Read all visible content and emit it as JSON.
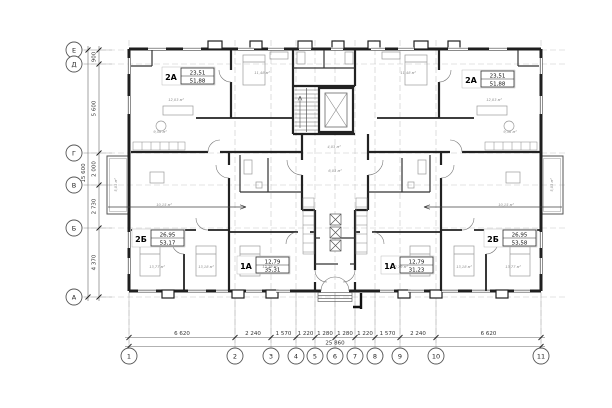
{
  "drawing": {
    "kind": "apartment floor plan"
  },
  "axes": {
    "left": [
      "Е",
      "Д",
      "Г",
      "В",
      "Б",
      "А"
    ],
    "bottom": [
      "1",
      "2",
      "3",
      "4",
      "5",
      "6",
      "7",
      "8",
      "9",
      "10",
      "11"
    ]
  },
  "dims": {
    "left": [
      "900",
      "5 600",
      "2 000",
      "2 730",
      "4 370"
    ],
    "left_total": "15 600",
    "bottom": [
      "6 620",
      "2 240",
      "1 570",
      "1 220",
      "1 280",
      "1 280",
      "1 220",
      "1 570",
      "2 240",
      "6 620"
    ],
    "bottom_total": "25 860"
  },
  "apartments": [
    {
      "type": "2А",
      "living": "23,51",
      "total": "51,88"
    },
    {
      "type": "2А",
      "living": "23,51",
      "total": "51,88"
    },
    {
      "type": "2Б",
      "living": "26,95",
      "total": "53,17"
    },
    {
      "type": "2Б",
      "living": "26,95",
      "total": "53,58"
    },
    {
      "type": "1А",
      "living": "12,79",
      "total": "35,31"
    },
    {
      "type": "1А",
      "living": "12,79",
      "total": "31,23"
    }
  ],
  "rooms": [
    {
      "label": "12,03 м²"
    },
    {
      "label": "11,48 м²"
    },
    {
      "label": "9,56 м²"
    },
    {
      "label": "12,03 м²"
    },
    {
      "label": "11,48 м²"
    },
    {
      "label": "9,56 м²"
    },
    {
      "label": "4,03 м²"
    },
    {
      "label": "6,03 м²"
    },
    {
      "label": "13,77 м²"
    },
    {
      "label": "13,18 м²"
    },
    {
      "label": "10,15 м²"
    },
    {
      "label": "13,77 м²"
    },
    {
      "label": "13,18 м²"
    },
    {
      "label": "10,15 м²"
    },
    {
      "label": "12,79 м²"
    },
    {
      "label": "12,79 м²"
    },
    {
      "label": "5,03 м²"
    },
    {
      "label": "5,03 м²"
    }
  ]
}
